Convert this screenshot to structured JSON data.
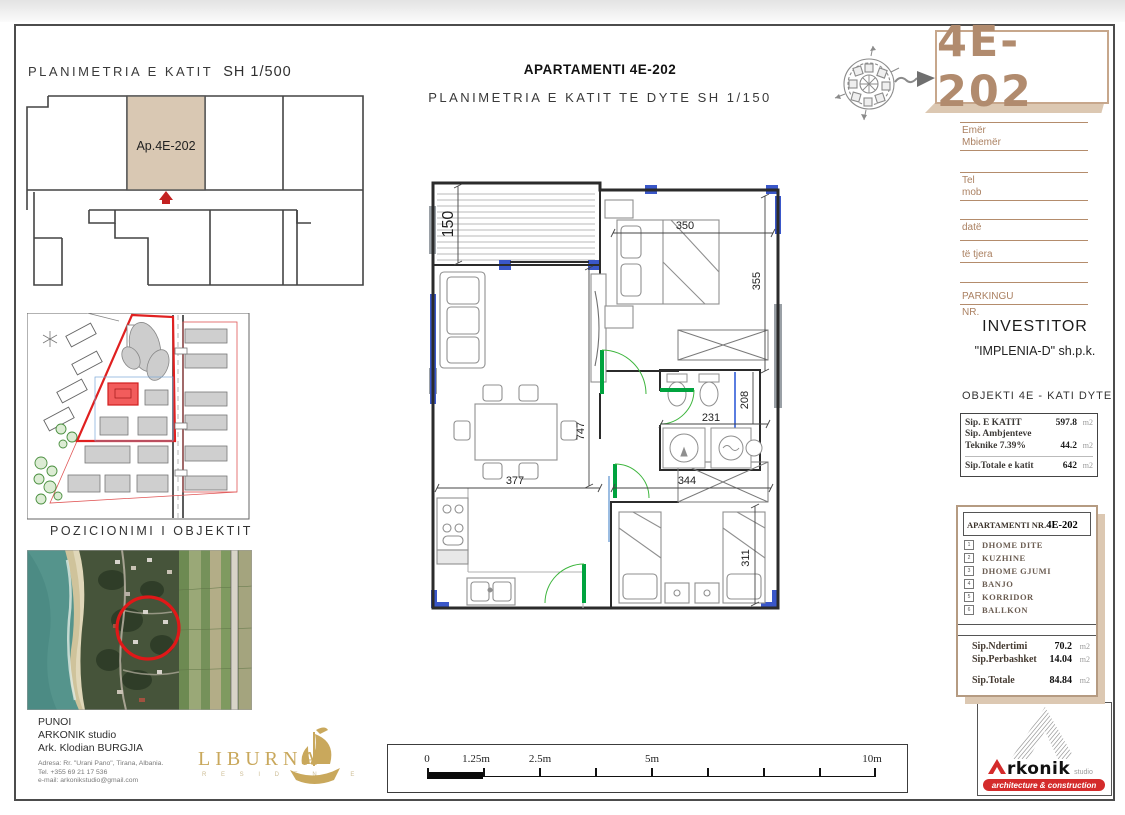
{
  "titles": {
    "key_plan": "PLANIMETRIA E KATIT",
    "key_plan_scale": "SH 1/500",
    "main": "APARTAMENTI 4E-202",
    "sub": "PLANIMETRIA E KATIT TE DYTE SH 1/150",
    "site_caption": "POZICIONIMI I OBJEKTIT"
  },
  "key_plan": {
    "apartment_label": "Ap.4E-202"
  },
  "code_box": {
    "code": "4E-202"
  },
  "form": {
    "emer": "Emër",
    "mbiemer": "Mbiemër",
    "tel": "Tel",
    "mob": "mob",
    "date": "datë",
    "te_tjera": "të tjera",
    "parkingu": "PARKINGU",
    "nr": "NR."
  },
  "investor": {
    "heading": "INVESTITOR",
    "name": "\"IMPLENIA-D\" sh.p.k."
  },
  "objekti": {
    "heading": "OBJEKTI 4E - KATI DYTE",
    "rows": [
      {
        "label": "Sip. E KATIT",
        "value": "597.8",
        "unit": "m2"
      },
      {
        "label": "Sip. Ambjenteve",
        "value": "",
        "unit": ""
      },
      {
        "label": "Teknike 7.39%",
        "value": "44.2",
        "unit": "m2"
      },
      {
        "label": "Sip.Totale e katit",
        "value": "642",
        "unit": "m2"
      }
    ]
  },
  "apartment_panel": {
    "heading": "APARTAMENTI NR.",
    "code": "4E-202",
    "rooms": [
      {
        "n": "1",
        "name": "DHOME DITE"
      },
      {
        "n": "2",
        "name": "KUZHINE"
      },
      {
        "n": "3",
        "name": "DHOME GJUMI"
      },
      {
        "n": "4",
        "name": "BANJO"
      },
      {
        "n": "5",
        "name": "KORRIDOR"
      },
      {
        "n": "6",
        "name": "BALLKON"
      }
    ],
    "totals": [
      {
        "label": "Sip.Ndertimi",
        "value": "70.2",
        "unit": "m2"
      },
      {
        "label": "Sip.Perbashket",
        "value": "14.04",
        "unit": "m2"
      },
      {
        "label": "Sip.Totale",
        "value": "84.84",
        "unit": "m2"
      }
    ]
  },
  "author": {
    "punoi": "PUNOI",
    "studio": "ARKONIK studio",
    "architect": "Ark. Klodian BURGJIA",
    "address": "Adresa: Rr. \"Urani Pano\", Tirana, Albania.",
    "tel": "Tel. +355 69 21 17 536",
    "email": "e-mail: arkonikstudio@gmail.com"
  },
  "liburna": {
    "name": "LIBURNA",
    "residence": "R E S I D E N C E"
  },
  "scalebar": {
    "labels": [
      "0",
      "1.25m",
      "2.5m",
      "5m",
      "10m"
    ]
  },
  "arkonik": {
    "brand": "rkonik",
    "studio": "studio",
    "banner": "architecture & construction"
  },
  "plan": {
    "dims": {
      "d150": "150",
      "d350": "350",
      "d355": "355",
      "d747": "747",
      "d231": "231",
      "d208": "208",
      "d377": "377",
      "d344": "344",
      "d311": "311"
    }
  },
  "colors": {
    "accent_tan": "#b18b6e",
    "green_door": "#00a33e",
    "blue_window": "#3a57c9",
    "red": "#d42b2b",
    "gold": "#c9a85c"
  }
}
